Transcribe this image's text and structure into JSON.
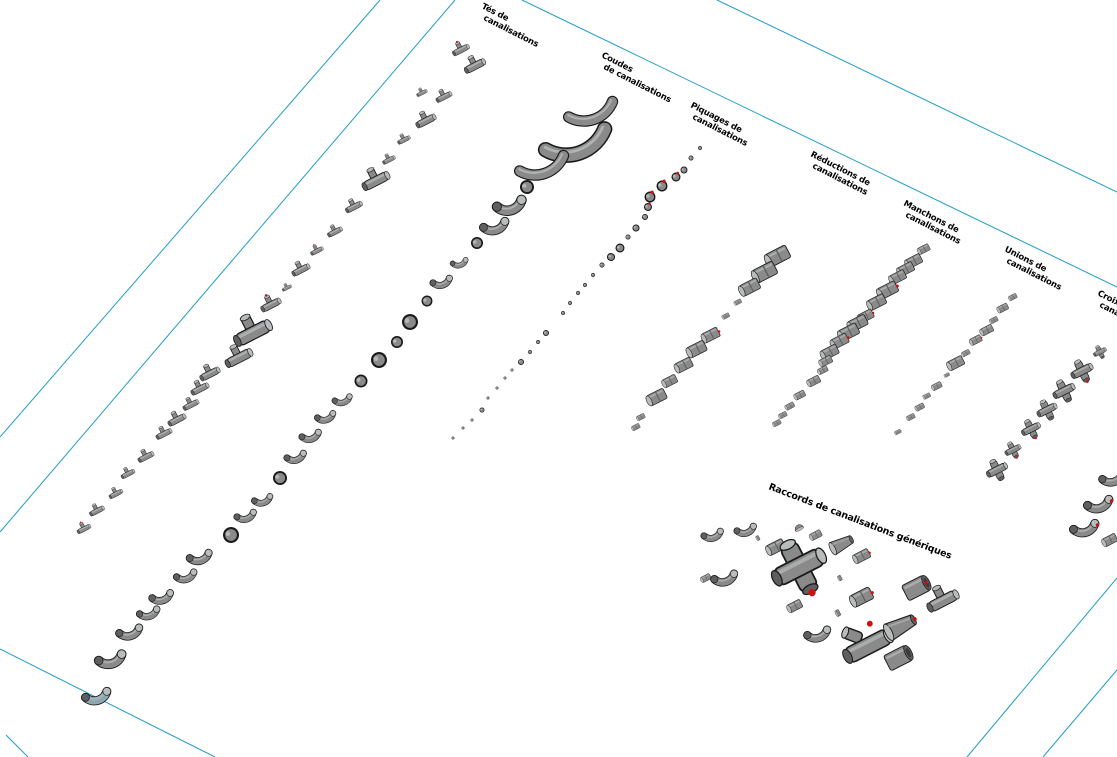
{
  "view": {
    "name": "3d-view-pipe-fittings-sheet",
    "width": 1117,
    "height": 757
  },
  "colors": {
    "background": "#ffffff",
    "sheet_line": "#1e9cc8",
    "body": "#8a8a8a",
    "light": "#b8bcbc",
    "shade": "#5f5f5f",
    "outline": "#1a1a1a",
    "dark_end": "#3c3c3c",
    "connector": "#cc1111",
    "teal_fitting": "#8fa8b0",
    "text": "#000000"
  },
  "sheet_lines": [
    {
      "x1": 380,
      "y1": 0,
      "x2": 0,
      "y2": 437
    },
    {
      "x1": 455,
      "y1": 0,
      "x2": 0,
      "y2": 532
    },
    {
      "x1": 717,
      "y1": 0,
      "x2": 1117,
      "y2": 192
    },
    {
      "x1": 522,
      "y1": 0,
      "x2": 1117,
      "y2": 287
    },
    {
      "x1": 0,
      "y1": 649,
      "x2": 215,
      "y2": 757
    },
    {
      "x1": 6,
      "y1": 735,
      "x2": 28,
      "y2": 757
    },
    {
      "x1": 1117,
      "y1": 578,
      "x2": 967,
      "y2": 757
    },
    {
      "x1": 1117,
      "y1": 670,
      "x2": 1043,
      "y2": 757
    }
  ],
  "columns": [
    {
      "id": "tes",
      "type": "tee",
      "label": {
        "lines": [
          "Tés de",
          "canalisations"
        ],
        "x": 481,
        "y": 8,
        "rot": 27
      },
      "items": [
        [
          461,
          50,
          16,
          1
        ],
        [
          475,
          66,
          20,
          0
        ],
        [
          444,
          97,
          15,
          0
        ],
        [
          422,
          93,
          10,
          0
        ],
        [
          426,
          121,
          19,
          0
        ],
        [
          404,
          140,
          12,
          0
        ],
        [
          389,
          160,
          12,
          0
        ],
        [
          376,
          181,
          26,
          0
        ],
        [
          354,
          207,
          16,
          0
        ],
        [
          335,
          232,
          14,
          0
        ],
        [
          317,
          251,
          12,
          1
        ],
        [
          301,
          270,
          17,
          0
        ],
        [
          287,
          288,
          9,
          0
        ],
        [
          271,
          305,
          19,
          1
        ],
        [
          253,
          333,
          36,
          0
        ],
        [
          239,
          358,
          26,
          0
        ],
        [
          210,
          374,
          19,
          0
        ],
        [
          200,
          389,
          17,
          0
        ],
        [
          191,
          405,
          15,
          0
        ],
        [
          177,
          420,
          17,
          0
        ],
        [
          164,
          434,
          15,
          0
        ],
        [
          146,
          457,
          15,
          0
        ],
        [
          128,
          474,
          13,
          0
        ],
        [
          116,
          494,
          13,
          0
        ],
        [
          97,
          511,
          14,
          0
        ],
        [
          84,
          529,
          13,
          1
        ]
      ]
    },
    {
      "id": "coudes",
      "type": "elbow",
      "teal_index": 28,
      "label": {
        "lines": [
          "Coudes",
          "de canalisations"
        ],
        "x": 601,
        "y": 57,
        "rot": 27
      },
      "items": [
        [
          592,
          112,
          46,
          0,
          "arc"
        ],
        [
          577,
          143,
          62,
          0,
          "arc"
        ],
        [
          543,
          166,
          46,
          0,
          "arc"
        ],
        [
          527,
          187,
          14,
          0,
          "dot"
        ],
        [
          509,
          204,
          30,
          0
        ],
        [
          494,
          225,
          26,
          0
        ],
        [
          477,
          243,
          12,
          0,
          "dot"
        ],
        [
          459,
          262,
          16,
          0
        ],
        [
          441,
          281,
          20,
          0
        ],
        [
          427,
          301,
          11,
          0,
          "dot"
        ],
        [
          410,
          322,
          16,
          0,
          "dot"
        ],
        [
          397,
          342,
          12,
          0,
          "dot"
        ],
        [
          379,
          360,
          16,
          0,
          "dot"
        ],
        [
          361,
          381,
          13,
          0,
          "dot"
        ],
        [
          342,
          399,
          18,
          0
        ],
        [
          325,
          416,
          19,
          0
        ],
        [
          310,
          435,
          20,
          0
        ],
        [
          295,
          456,
          20,
          0
        ],
        [
          280,
          478,
          14,
          0,
          "dot"
        ],
        [
          262,
          499,
          19,
          0
        ],
        [
          245,
          515,
          20,
          0
        ],
        [
          231,
          535,
          16,
          0,
          "dot"
        ],
        [
          199,
          556,
          23,
          0
        ],
        [
          185,
          575,
          21,
          0
        ],
        [
          161,
          596,
          22,
          0
        ],
        [
          148,
          612,
          21,
          0
        ],
        [
          129,
          631,
          24,
          0
        ],
        [
          110,
          658,
          28,
          0
        ],
        [
          96,
          695,
          26,
          0
        ]
      ]
    },
    {
      "id": "piquages",
      "type": "dot",
      "label": {
        "lines": [
          "Piquages de",
          "canalisations"
        ],
        "x": 690,
        "y": 107,
        "rot": 27
      },
      "items": [
        [
          700,
          148,
          4,
          0
        ],
        [
          691,
          158,
          5,
          0
        ],
        [
          684,
          170,
          7,
          0
        ],
        [
          676,
          177,
          9,
          1
        ],
        [
          662,
          186,
          11,
          1
        ],
        [
          650,
          197,
          11,
          1
        ],
        [
          648,
          207,
          8,
          1
        ],
        [
          645,
          217,
          6,
          0
        ],
        [
          636,
          228,
          7,
          0
        ],
        [
          628,
          237,
          5,
          0
        ],
        [
          620,
          248,
          9,
          0
        ],
        [
          611,
          257,
          8,
          0
        ],
        [
          602,
          265,
          5,
          0
        ],
        [
          593,
          275,
          4,
          0
        ],
        [
          585,
          285,
          4,
          0
        ],
        [
          578,
          293,
          4,
          0
        ],
        [
          570,
          303,
          4,
          0
        ],
        [
          563,
          313,
          4,
          0
        ],
        [
          546,
          333,
          6,
          0
        ],
        [
          538,
          342,
          4,
          0
        ],
        [
          530,
          352,
          4,
          0
        ],
        [
          521,
          362,
          6,
          0
        ],
        [
          512,
          370,
          3,
          0
        ],
        [
          505,
          378,
          3,
          0
        ],
        [
          497,
          388,
          3,
          0
        ],
        [
          488,
          398,
          3,
          0
        ],
        [
          482,
          410,
          5,
          0
        ],
        [
          472,
          420,
          3,
          0
        ],
        [
          463,
          428,
          3,
          0
        ],
        [
          453,
          438,
          3,
          0
        ]
      ]
    },
    {
      "id": "reductions",
      "type": "drum",
      "label": {
        "lines": [
          "Réductions de",
          "canalisations"
        ],
        "x": 810,
        "y": 156,
        "rot": 27
      },
      "items": [
        [
          778,
          256,
          26,
          0
        ],
        [
          765,
          272,
          26,
          0
        ],
        [
          750,
          287,
          22,
          0
        ],
        [
          738,
          302,
          8,
          0
        ],
        [
          726,
          316,
          8,
          0
        ],
        [
          711,
          335,
          19,
          1
        ],
        [
          697,
          349,
          21,
          0
        ],
        [
          684,
          365,
          19,
          0
        ],
        [
          670,
          381,
          16,
          0
        ],
        [
          657,
          397,
          21,
          0
        ],
        [
          641,
          417,
          9,
          0
        ],
        [
          636,
          427,
          9,
          0
        ]
      ]
    },
    {
      "id": "manchons",
      "type": "drum",
      "label": {
        "lines": [
          "Manchons de",
          "canalisations"
        ],
        "x": 903,
        "y": 205,
        "rot": 27
      },
      "items": [
        [
          924,
          249,
          13,
          0
        ],
        [
          914,
          261,
          18,
          0
        ],
        [
          906,
          269,
          18,
          0
        ],
        [
          898,
          277,
          18,
          0
        ],
        [
          888,
          290,
          22,
          1
        ],
        [
          877,
          302,
          20,
          0
        ],
        [
          866,
          316,
          17,
          1
        ],
        [
          858,
          323,
          21,
          0
        ],
        [
          849,
          332,
          22,
          0
        ],
        [
          840,
          341,
          19,
          1
        ],
        [
          830,
          352,
          19,
          0
        ],
        [
          826,
          361,
          14,
          0
        ],
        [
          823,
          370,
          11,
          0
        ],
        [
          814,
          381,
          14,
          0
        ],
        [
          800,
          395,
          12,
          0
        ],
        [
          790,
          406,
          10,
          0
        ],
        [
          783,
          415,
          9,
          0
        ],
        [
          777,
          423,
          9,
          0
        ]
      ]
    },
    {
      "id": "unions",
      "type": "drum",
      "label": {
        "lines": [
          "Unions de",
          "canalisations"
        ],
        "x": 1004,
        "y": 251,
        "rot": 27
      },
      "items": [
        [
          1013,
          297,
          9,
          0
        ],
        [
          1003,
          308,
          12,
          0
        ],
        [
          994,
          320,
          9,
          0
        ],
        [
          987,
          330,
          14,
          0
        ],
        [
          976,
          340,
          13,
          1
        ],
        [
          966,
          353,
          9,
          0
        ],
        [
          956,
          363,
          18,
          0
        ],
        [
          947,
          375,
          6,
          0
        ],
        [
          937,
          386,
          11,
          0
        ],
        [
          927,
          396,
          8,
          0
        ],
        [
          920,
          407,
          10,
          0
        ],
        [
          911,
          417,
          9,
          0
        ],
        [
          898,
          432,
          7,
          1
        ]
      ]
    },
    {
      "id": "croix",
      "type": "cross",
      "label": {
        "lines": [
          "Croix de",
          "canalisations"
        ],
        "x": 1097,
        "y": 295,
        "rot": 27
      },
      "items": [
        [
          1100,
          352,
          13,
          0
        ],
        [
          1082,
          371,
          22,
          1
        ],
        [
          1064,
          391,
          22,
          0
        ],
        [
          1047,
          410,
          20,
          0
        ],
        [
          1031,
          429,
          19,
          1
        ],
        [
          1013,
          450,
          16,
          1
        ],
        [
          997,
          470,
          21,
          0
        ]
      ]
    },
    {
      "id": "edge-partial",
      "type": "elbow",
      "label": {
        "lines": [
          ""
        ],
        "x": 1130,
        "y": 330,
        "rot": 27
      },
      "items": [
        [
          1112,
          477,
          24,
          1
        ],
        [
          1098,
          503,
          26,
          1
        ],
        [
          1084,
          527,
          26,
          1
        ],
        [
          1110,
          540,
          16,
          0,
          "drum"
        ]
      ]
    }
  ],
  "cluster": {
    "label": {
      "lines": [
        "Raccords de canalisations génériques"
      ],
      "x": 768,
      "y": 489,
      "rot": 21
    },
    "items": [
      [
        "elbow",
        712,
        534,
        20,
        0
      ],
      [
        "elbow",
        745,
        529,
        20,
        0
      ],
      [
        "ring",
        758,
        538,
        9,
        0
      ],
      [
        "drum",
        776,
        547,
        20,
        0
      ],
      [
        "cap",
        799,
        528,
        14,
        0
      ],
      [
        "drum",
        816,
        535,
        13,
        0
      ],
      [
        "cone",
        842,
        544,
        24,
        0
      ],
      [
        "drum",
        862,
        556,
        18,
        1
      ],
      [
        "drum",
        706,
        578,
        11,
        0
      ],
      [
        "elbow",
        724,
        577,
        24,
        0
      ],
      [
        "cross",
        799,
        567,
        54,
        1
      ],
      [
        "ring",
        840,
        578,
        10,
        0
      ],
      [
        "drum",
        862,
        597,
        24,
        1
      ],
      [
        "bigdrum",
        916,
        588,
        28,
        1
      ],
      [
        "tee",
        943,
        601,
        30,
        0
      ],
      [
        "drum",
        795,
        606,
        16,
        0
      ],
      [
        "elbow",
        817,
        633,
        24,
        0
      ],
      [
        "ring",
        838,
        613,
        12,
        0
      ],
      [
        "wye",
        868,
        646,
        44,
        1
      ],
      [
        "cone",
        901,
        626,
        32,
        1
      ],
      [
        "bigdrum",
        898,
        658,
        28,
        0
      ]
    ]
  }
}
